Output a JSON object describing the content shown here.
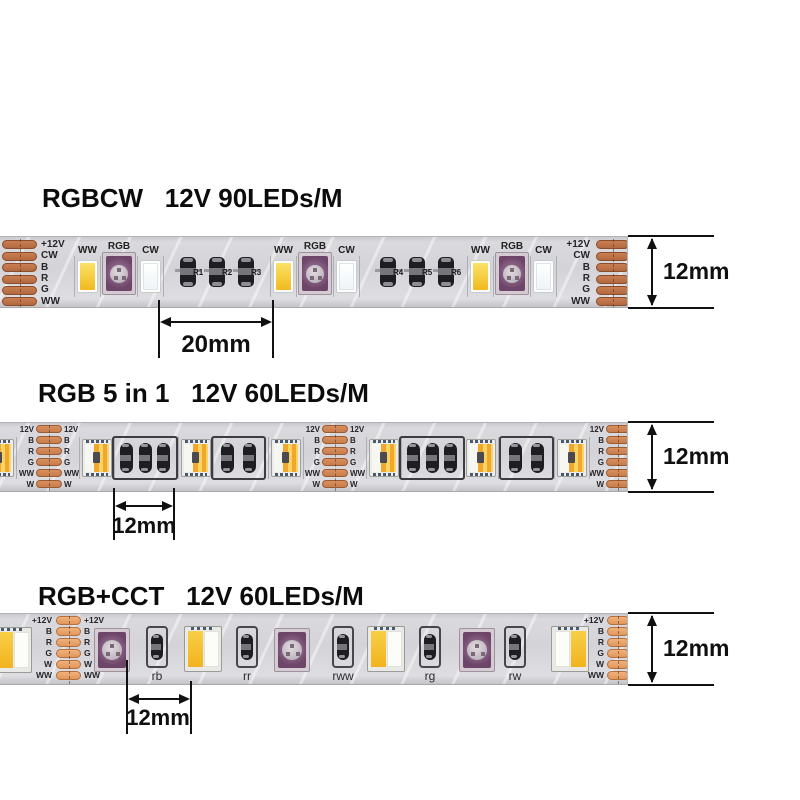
{
  "sections": [
    {
      "title": "RGBCW   12V 90LEDs/M",
      "pad_labels": [
        "+12V",
        "CW",
        "B",
        "R",
        "G",
        "WW"
      ],
      "led_labels": {
        "ww": "WW",
        "rgb": "RGB",
        "cw": "CW"
      },
      "resistor_labels": [
        "R1",
        "R2",
        "R3",
        "R4",
        "R5",
        "R6"
      ],
      "pitch_dim": "20mm",
      "width_dim": "12mm"
    },
    {
      "title": "RGB 5 in 1   12V 60LEDs/M",
      "pad_labels": [
        "12V",
        "B",
        "R",
        "G",
        "WW",
        "W"
      ],
      "pitch_dim": "12mm",
      "width_dim": "12mm"
    },
    {
      "title": "RGB+CCT   12V 60LEDs/M",
      "pad_labels": [
        "+12V",
        "B",
        "R",
        "G",
        "W",
        "WW"
      ],
      "resistor_labels": [
        "rb",
        "rr",
        "rww",
        "rg",
        "rw"
      ],
      "pitch_dim": "12mm",
      "width_dim": "12mm"
    }
  ],
  "colors": {
    "copper_dark": "#b26840",
    "copper_dark_hi": "#ca7e52",
    "copper_mid": "#c87c4c",
    "copper_mid_hi": "#d98f5e",
    "copper_light": "#e2975c",
    "copper_light_hi": "#f0b27b",
    "strip_body": "#d6d6da",
    "ww_yellow": "#f2ba1e",
    "ww_yellow_hi": "#fae268",
    "cw_white": "#eef4f7",
    "rgb_purple": "#6d4569",
    "rgb_purple_hi": "#8a6386",
    "cct_amber": "#f2b31f",
    "cct_amber_hi": "#f8cf46",
    "five_orange": "#f2a62c",
    "five_gold": "#f8d464",
    "resistor_black": "#1e1e22",
    "dim_ink": "#111111"
  }
}
